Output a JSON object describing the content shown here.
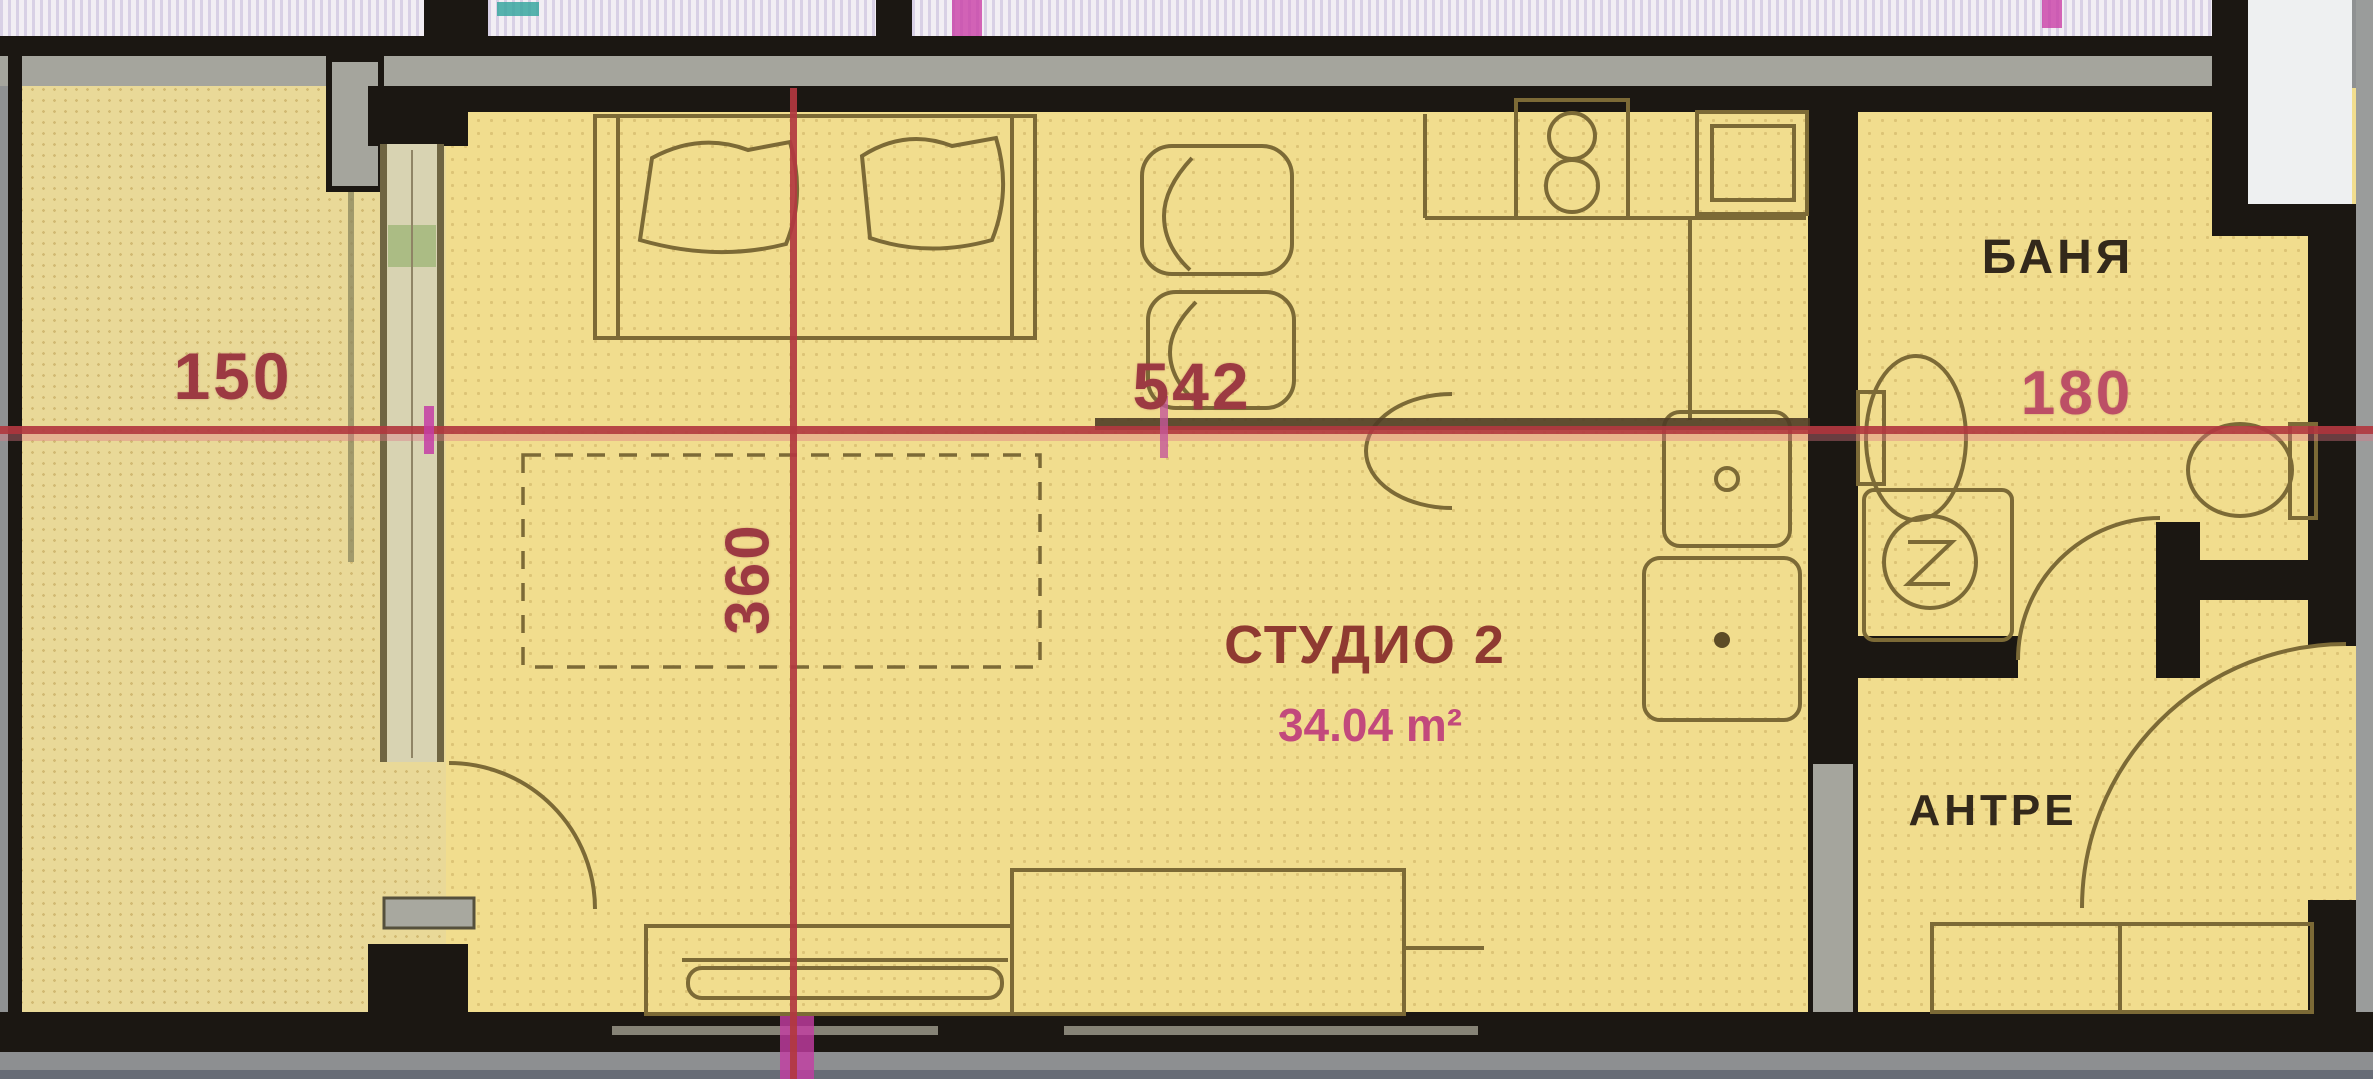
{
  "unit": {
    "name": "СТУДИО 2",
    "area": "34.04 m²"
  },
  "rooms": {
    "bathroom": "БАНЯ",
    "hall": "АНТРЕ"
  },
  "dimensions": {
    "terrace_width": "150",
    "studio_width": "542",
    "studio_depth": "360",
    "bathroom_width": "180"
  },
  "colors": {
    "floor_yellow": "#f1dd8e",
    "terrace_yellow": "#e9d998",
    "wall_dark": "#1b1712",
    "dimension_red": "#b23840",
    "dimension_magenta": "#c43ca4",
    "unit_label_red": "#8f3a31",
    "area_pink": "#c2497c",
    "room_label_dark": "#33291b",
    "furniture_line": "#7c6a36"
  }
}
